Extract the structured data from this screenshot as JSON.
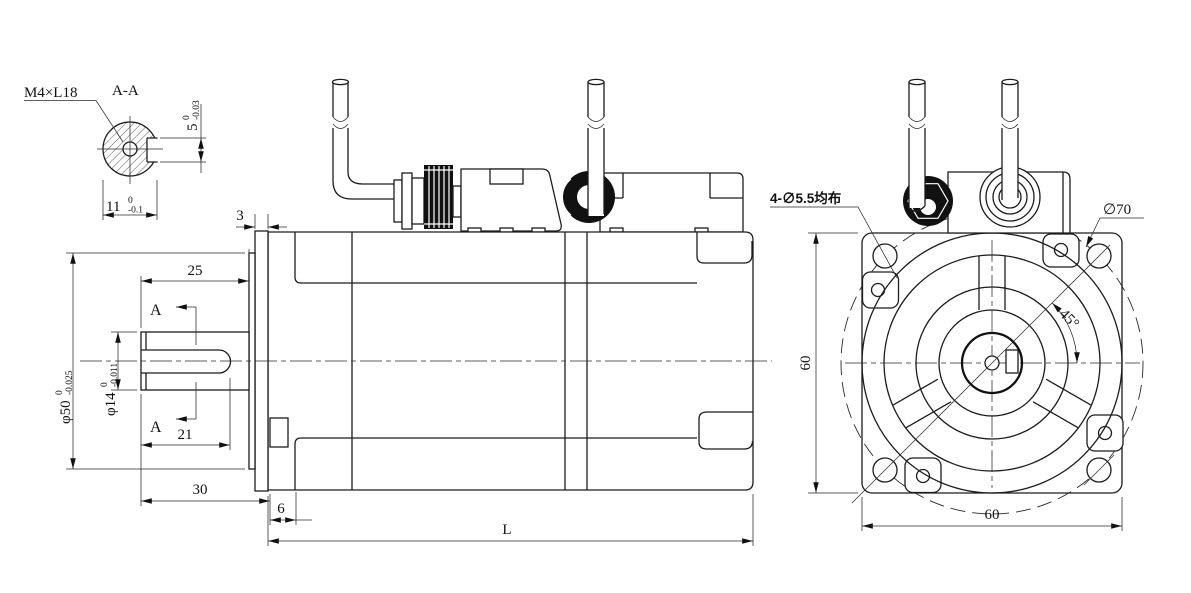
{
  "detail_view": {
    "title": "A-A",
    "thread_callout": "M4×L18",
    "keyway_depth": "5",
    "keyway_depth_tol_upper": "0",
    "keyway_depth_tol_lower": "-0.03",
    "keyway_across": "11",
    "keyway_across_tol_upper": "0",
    "keyway_across_tol_lower": "-0.1"
  },
  "side_view": {
    "spigot_thickness": "3",
    "shaft_ext_length": "25",
    "keyway_length": "21",
    "shaft_total_length": "30",
    "front_cap_width": "6",
    "body_length": "L",
    "section_mark": "A",
    "spigot_dia": "φ50",
    "spigot_tol_upper": "0",
    "spigot_tol_lower": "-0.025",
    "shaft_dia": "φ14",
    "shaft_tol_upper": "0",
    "shaft_tol_lower": "-0.011"
  },
  "front_view": {
    "hole_callout": "4-∅5.5均布",
    "bolt_circle_dia": "∅70",
    "angle": "45°",
    "flange_width": "60",
    "flange_height": "60"
  },
  "line_color": "#1c1c1c",
  "background": "#ffffff"
}
